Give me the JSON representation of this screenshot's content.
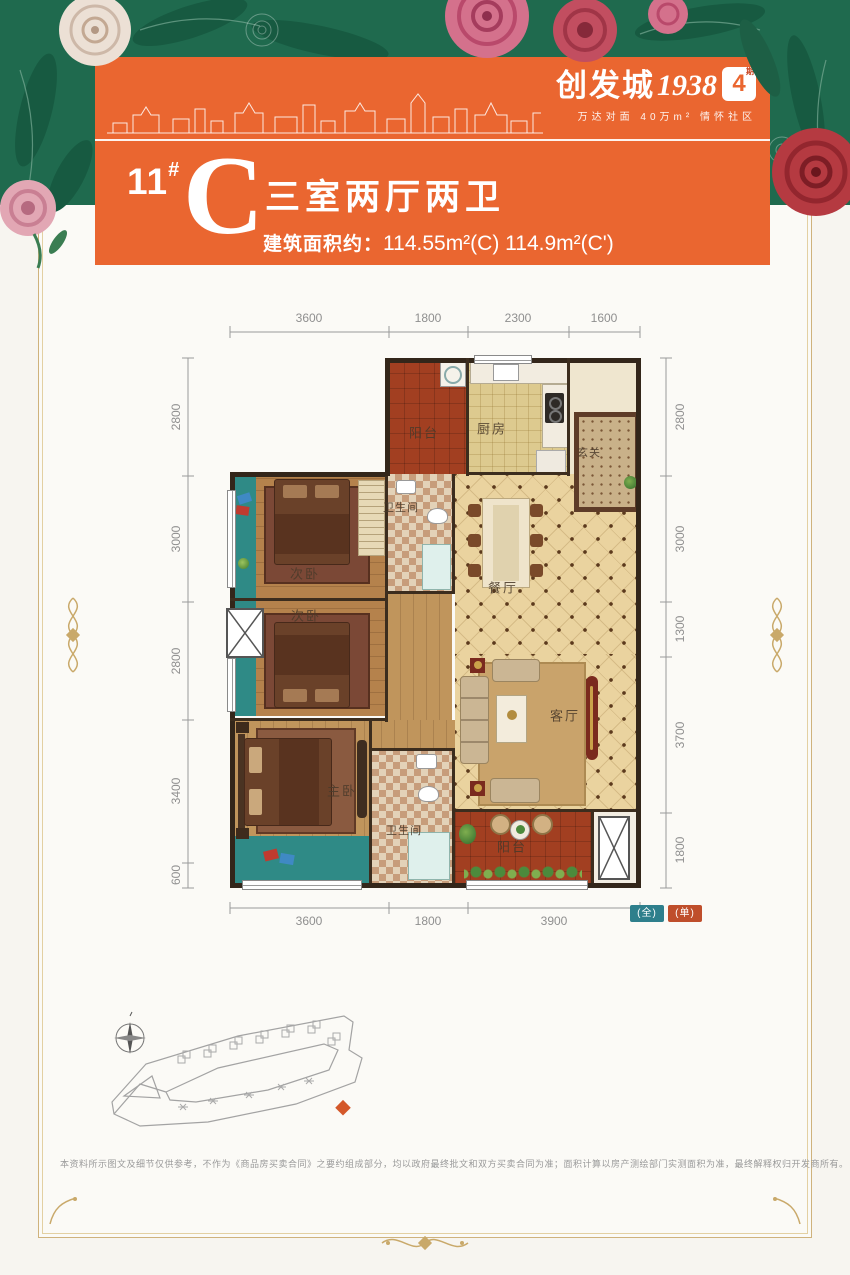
{
  "header": {
    "logo": {
      "brand": "创发城",
      "year": "1938",
      "phase": "4",
      "phase_unit": "期",
      "tagline": "万达对面 40万m² 情怀社区"
    },
    "unit": {
      "building": "11",
      "hash": "#",
      "type": "C",
      "rooms": "三室两厅两卫",
      "area_label": "建筑面积约：",
      "area": "114.55m²(C) 114.9m²(C')"
    }
  },
  "plan": {
    "dims_top": [
      "3600",
      "1800",
      "2300",
      "1600"
    ],
    "dims_bottom": [
      "3600",
      "1800",
      "3900"
    ],
    "dims_left": [
      "2800",
      "3000",
      "2800",
      "3400",
      "600"
    ],
    "dims_right": [
      "2800",
      "3000",
      "1300",
      "3700",
      "1800"
    ],
    "rooms": {
      "balcony_top": "阳台",
      "kitchen": "厨房",
      "foyer": "玄关",
      "bedroom_a": "次卧",
      "bath_a": "卫生间",
      "dining": "餐厅",
      "bedroom_b": "次卧",
      "living": "客厅",
      "master": "主卧",
      "bath_b": "卫生间",
      "balcony_bottom": "阳台"
    },
    "legend": {
      "full": "(全)",
      "single": "(单)",
      "full_color": "#2e7f8c",
      "single_color": "#bf4e2b"
    }
  },
  "footer": {
    "disclaimer": "本资料所示图文及细节仅供参考，不作为《商品房买卖合同》之要约组成部分，均以政府最终批文和双方买卖合同为准；面积计算以房产测绘部门实测面积为准，最终解释权归开发商所有。"
  },
  "colors": {
    "banner_orange": "#ea6630",
    "floral_green": "#1f6a4e",
    "legend_teal": "#2e7f8c",
    "legend_red": "#bf4e2b",
    "balcony_terracotta": "#a23f21"
  }
}
